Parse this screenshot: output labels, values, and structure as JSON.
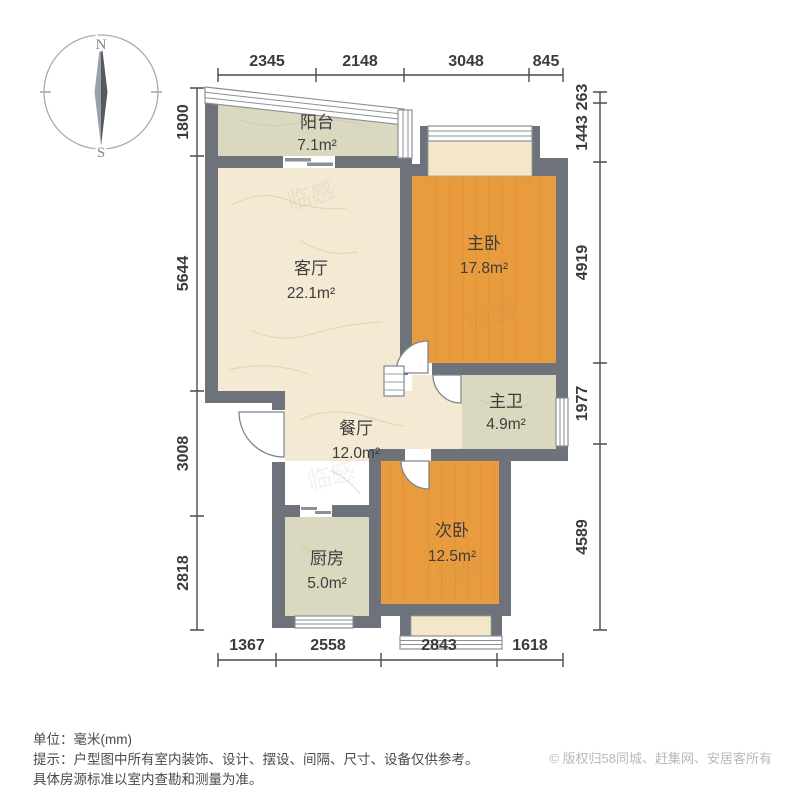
{
  "compass": {
    "north_label": "N",
    "south_label": "S"
  },
  "rooms": [
    {
      "id": "balcony",
      "name": "阳台",
      "area": "7.1m²"
    },
    {
      "id": "living-room",
      "name": "客厅",
      "area": "22.1m²"
    },
    {
      "id": "master-bedroom",
      "name": "主卧",
      "area": "17.8m²"
    },
    {
      "id": "dining-room",
      "name": "餐厅",
      "area": "12.0m²"
    },
    {
      "id": "master-bath",
      "name": "主卫",
      "area": "4.9m²"
    },
    {
      "id": "second-bedroom",
      "name": "次卧",
      "area": "12.5m²"
    },
    {
      "id": "kitchen",
      "name": "厨房",
      "area": "5.0m²"
    }
  ],
  "dimensions": {
    "top": [
      "2345",
      "2148",
      "3048",
      "845"
    ],
    "bottom": [
      "1367",
      "2558",
      "2843",
      "1618"
    ],
    "left": [
      "1800",
      "5644",
      "3008",
      "2818"
    ],
    "right": [
      "263",
      "1443",
      "4919",
      "1977",
      "4589"
    ]
  },
  "colors": {
    "wall": "#6d727b",
    "marble_floor": "#f4e9d3",
    "wood_floor": "#e99c3e",
    "tile_floor": "#dbd8c0",
    "bay_sill": "#f3e6c9",
    "window_frame": "#8b9097",
    "dim_text": "#3b3b3b"
  },
  "watermark_text": "临感",
  "footer": {
    "unit_line": "单位：毫米(mm)",
    "tip_line1": "提示：户型图中所有室内装饰、设计、摆设、间隔、尺寸、设备仅供参考。",
    "tip_line2": "具体房源标准以室内查勘和测量为准。",
    "copyright": "© 版权归58同城、赶集网、安居客所有"
  }
}
